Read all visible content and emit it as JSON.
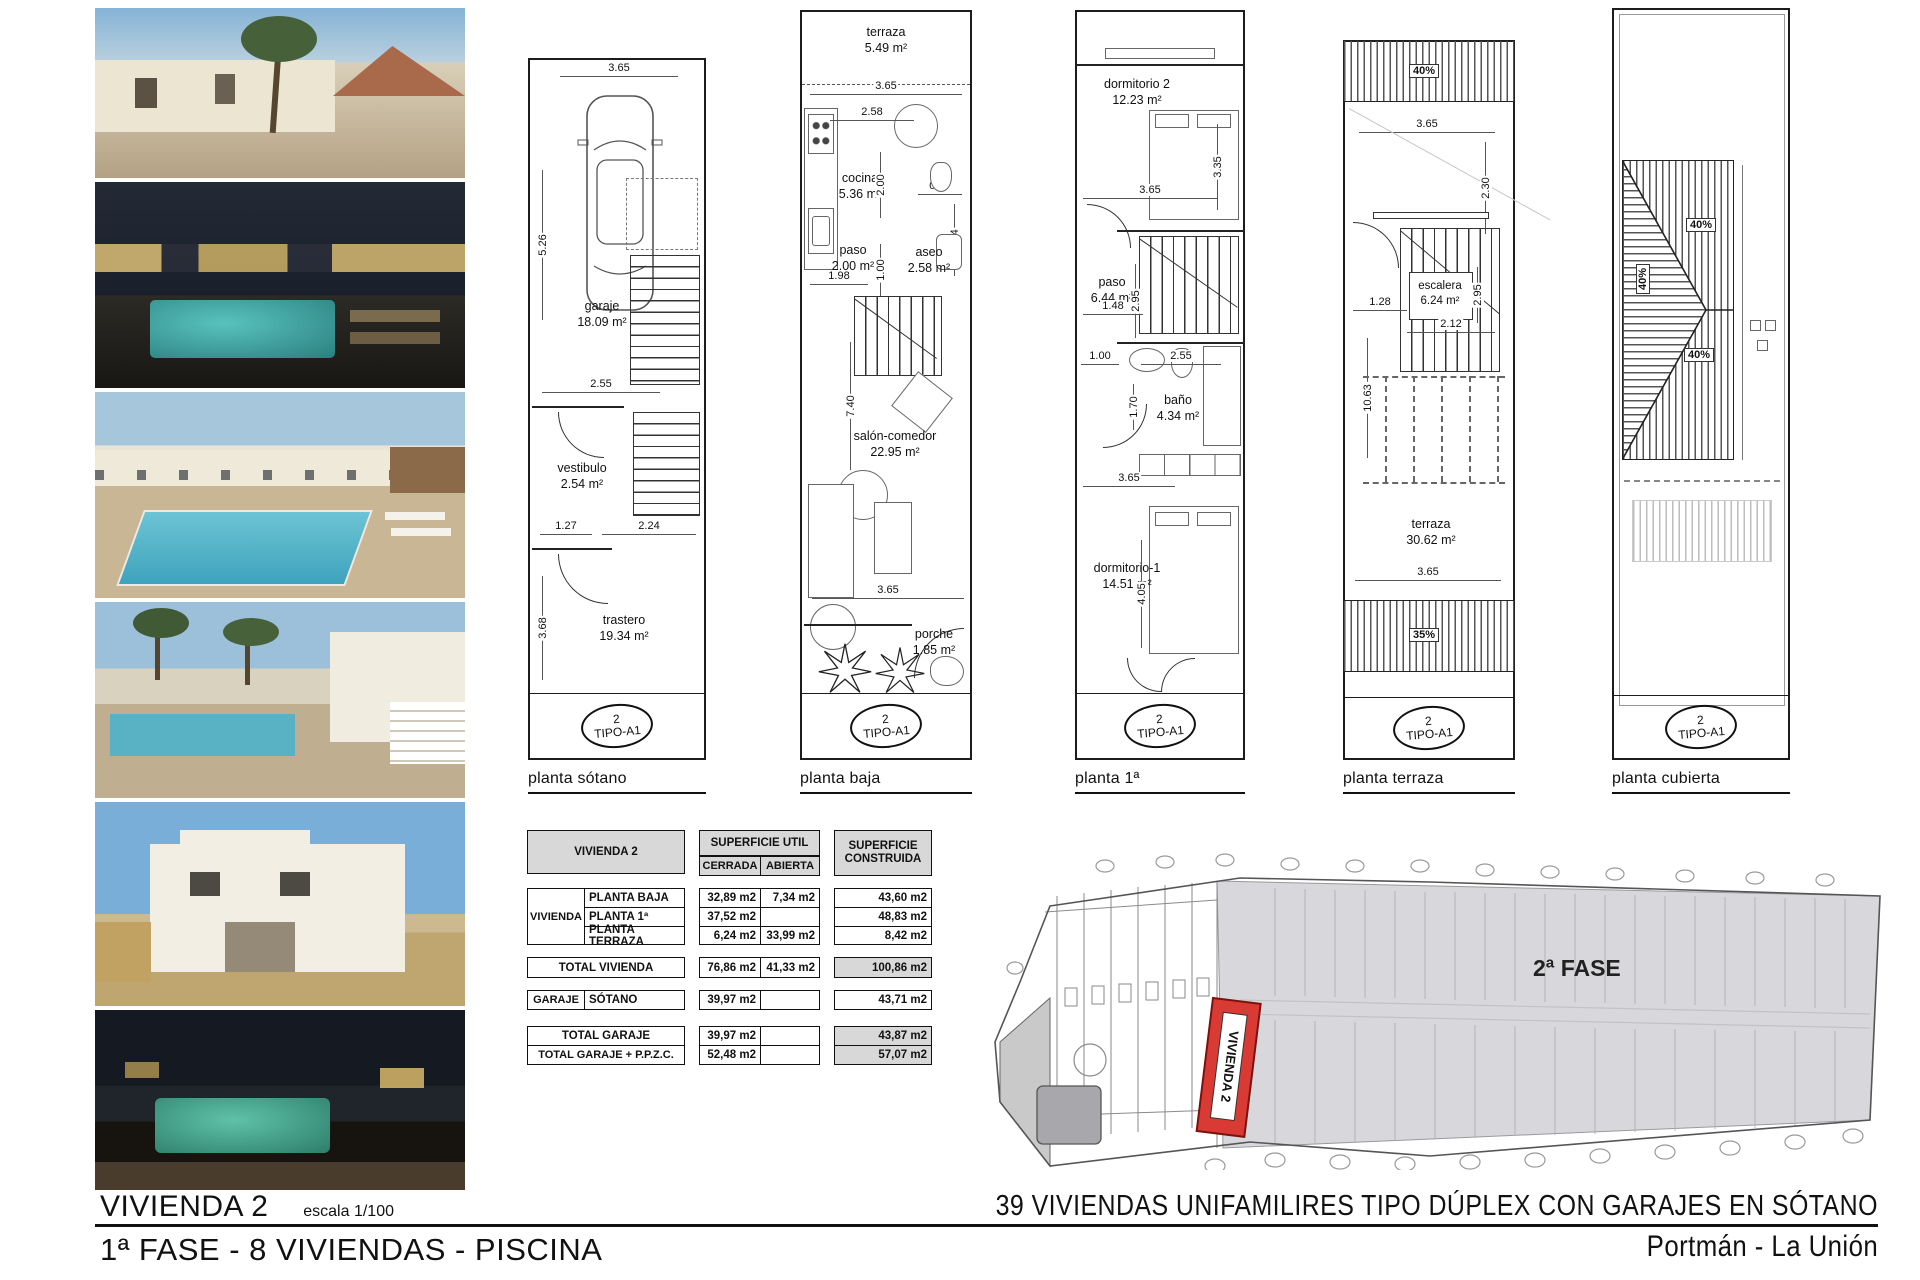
{
  "sheet": {
    "bottom_left": {
      "title": "VIVIENDA 2",
      "scale": "escala 1/100",
      "phase_line": "1ª FASE - 8 VIVIENDAS - PISCINA"
    },
    "bottom_right": {
      "project_title": "39 VIVIENDAS UNIFAMILIRES TIPO DÚPLEX CON GARAJES EN SÓTANO",
      "location": "Portmán - La Unión"
    }
  },
  "colors": {
    "accent_red": "#d93a34",
    "table_header_gray": "#d8d8d8",
    "siteplan_gray": "#d8d8dc",
    "line": "#1c1c1c"
  },
  "stamp": {
    "num": "2",
    "tipo": "TIPO-A1"
  },
  "photos": [
    {
      "name": "street-elevation-day"
    },
    {
      "name": "pool-courtyard-night"
    },
    {
      "name": "pool-terrace-day"
    },
    {
      "name": "pool-palms-day"
    },
    {
      "name": "duplex-facade-day"
    },
    {
      "name": "pool-deck-night"
    }
  ],
  "plans": {
    "sotano": {
      "caption": "planta sótano",
      "rooms": {
        "garaje": "garaje",
        "garaje_area": "18.09 m²",
        "vestibulo": "vestibulo",
        "vestibulo_area": "2.54 m²",
        "trastero": "trastero",
        "trastero_area": "19.34 m²"
      },
      "dims": {
        "w_top": "3.65",
        "h_upper": "5.26",
        "w_255": "2.55",
        "w_127": "1.27",
        "w_224": "2.24",
        "h_lower": "3.68"
      }
    },
    "baja": {
      "caption": "planta baja",
      "rooms": {
        "terraza": "terraza",
        "terraza_area": "5.49 m²",
        "cocina": "cocina",
        "cocina_area": "5.36 m²",
        "paso": "paso",
        "paso_area": "2.00 m²",
        "aseo": "aseo",
        "aseo_area": "2.58 m²",
        "salon": "salón-comedor",
        "salon_area": "22.95 m²",
        "porche": "porche",
        "porche_area": "1.85 m²"
      },
      "dims": {
        "w_top": "3.65",
        "w_258": "2.58",
        "v_200": "2.00",
        "w_097": "0.97",
        "v_234": "2.34",
        "v_100": "1.00",
        "w_198": "1.98",
        "v_740": "7.40",
        "w_mid": "3.65"
      }
    },
    "primera": {
      "caption": "planta 1ª",
      "rooms": {
        "dorm2": "dormitorio 2",
        "dorm2_area": "12.23 m²",
        "paso": "paso",
        "paso_area": "6.44 m²",
        "bano": "baño",
        "bano_area": "4.34 m²",
        "dorm1": "dormitorio-1",
        "dorm1_area": "14.51 m²"
      },
      "dims": {
        "v_335": "3.35",
        "w_upper": "3.65",
        "v_295": "2.95",
        "w_148": "1.48",
        "w_100": "1.00",
        "w_255": "2.55",
        "v_170": "1.70",
        "w_lower": "3.65",
        "v_405": "4.05"
      }
    },
    "terraza": {
      "caption": "planta terraza",
      "rooms": {
        "escalera": "escalera",
        "escalera_area": "6.24 m²",
        "terraza": "terraza",
        "terraza_area": "30.62 m²"
      },
      "dims": {
        "w_top": "3.65",
        "v_230": "2.30",
        "w_128": "1.28",
        "v_295": "2.95",
        "w_212": "2.12",
        "v_1063": "10.63",
        "w_low": "3.65"
      },
      "slopes": {
        "top": "40%",
        "bottom": "35%"
      }
    },
    "cubierta": {
      "caption": "planta cubierta",
      "slopes": {
        "a": "40%",
        "b": "40%",
        "c": "40%"
      }
    }
  },
  "table": {
    "title": "VIVIENDA 2",
    "col_util": "SUPERFICIE UTIL",
    "col_construida": "SUPERFICIE CONSTRUIDA",
    "sub_cerrada": "CERRADA",
    "sub_abierta": "ABIERTA",
    "group_vivienda": "VIVIENDA",
    "group_garaje": "GARAJE",
    "rows": [
      {
        "label": "PLANTA BAJA",
        "cerrada": "32,89 m2",
        "abierta": "7,34 m2",
        "construida": "43,60 m2"
      },
      {
        "label": "PLANTA 1ª",
        "cerrada": "37,52 m2",
        "abierta": "",
        "construida": "48,83 m2"
      },
      {
        "label": "PLANTA TERRAZA",
        "cerrada": "6,24 m2",
        "abierta": "33,99 m2",
        "construida": "8,42 m2"
      }
    ],
    "total_vivienda": {
      "label": "TOTAL VIVIENDA",
      "cerrada": "76,86 m2",
      "abierta": "41,33 m2",
      "construida": "100,86 m2"
    },
    "garaje_row": {
      "label": "SÓTANO",
      "cerrada": "39,97 m2",
      "construida": "43,71 m2"
    },
    "total_garaje": {
      "label": "TOTAL GARAJE",
      "cerrada": "39,97 m2",
      "construida": "43,87 m2"
    },
    "total_ppzc": {
      "label": "TOTAL GARAJE + P.P.Z.C.",
      "cerrada": "52,48 m2",
      "construida": "57,07 m2"
    }
  },
  "siteplan": {
    "phase": "2ª FASE",
    "vivienda": "VIVIENDA 2"
  }
}
